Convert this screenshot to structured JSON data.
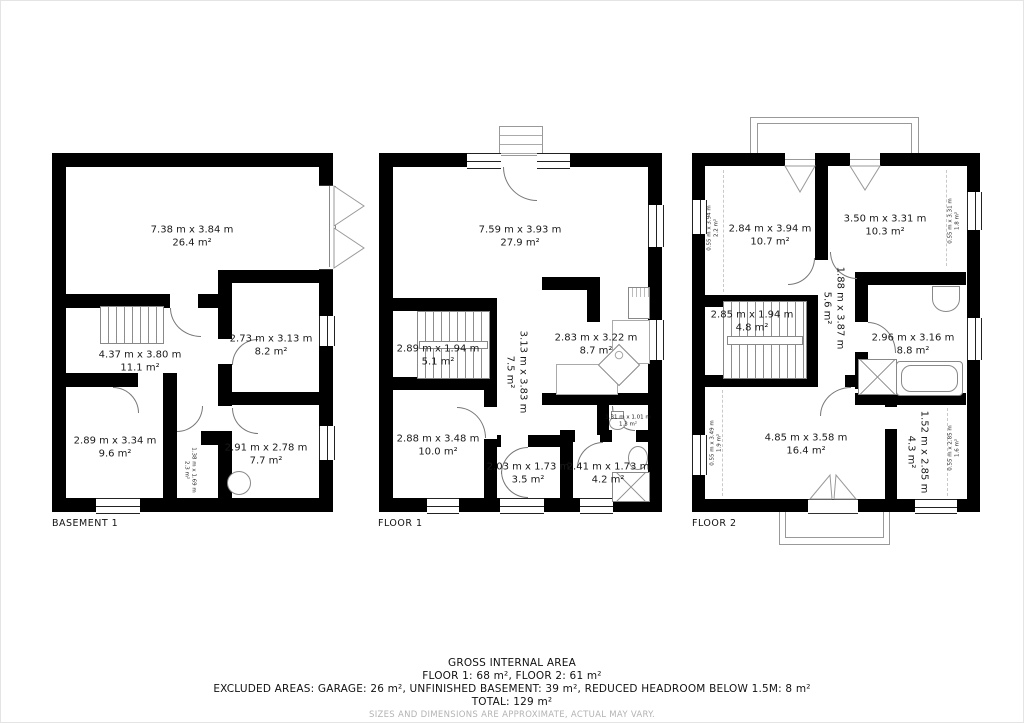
{
  "plans": [
    {
      "label": "BASEMENT 1",
      "rooms": [
        {
          "dims": "7.38 m x 3.84 m",
          "area": "26.4 m²"
        },
        {
          "dims": "4.37 m x 3.80 m",
          "area": "11.1 m²"
        },
        {
          "dims": "2.73 m x 3.13 m",
          "area": "8.2 m²"
        },
        {
          "dims": "2.89 m x 3.34 m",
          "area": "9.6 m²"
        },
        {
          "dims": "1.38 m x 1.69 m",
          "area": "2.3 m²"
        },
        {
          "dims": "2.91 m x 2.78 m",
          "area": "7.7 m²"
        }
      ]
    },
    {
      "label": "FLOOR 1",
      "rooms": [
        {
          "dims": "7.59 m x 3.93 m",
          "area": "27.9 m²"
        },
        {
          "dims": "2.89 m x 1.94 m",
          "area": "5.1 m²"
        },
        {
          "dims": "3.13 m x 3.83 m",
          "area": "7.5 m²"
        },
        {
          "dims": "2.83 m x 3.22 m",
          "area": "8.7 m²"
        },
        {
          "dims": "2.88 m x 3.48 m",
          "area": "10.0 m²"
        },
        {
          "dims": "2.03 m x 1.73 m",
          "area": "3.5 m²"
        },
        {
          "dims": "2.41 m x 1.73 m",
          "area": "4.2 m²"
        },
        {
          "dims": "1.31 m x 1.01 m",
          "area": "1.3 m²"
        }
      ]
    },
    {
      "label": "FLOOR 2",
      "rooms": [
        {
          "dims": "2.84 m x 3.94 m",
          "area": "10.7 m²"
        },
        {
          "dims": "3.50 m x 3.31 m",
          "area": "10.3 m²"
        },
        {
          "dims": "2.85 m x 1.94 m",
          "area": "4.8 m²"
        },
        {
          "dims": "1.88 m x 3.87 m",
          "area": "5.6 m²"
        },
        {
          "dims": "2.96 m x 3.16 m",
          "area": "8.8 m²"
        },
        {
          "dims": "4.85 m x 3.58 m",
          "area": "16.4 m²"
        },
        {
          "dims": "1.52 m x 2.85 m",
          "area": "4.3 m²"
        },
        {
          "dims": "0.55 m x 3.94 m",
          "area": "2.2 m²"
        },
        {
          "dims": "0.55 m x 3.31 m",
          "area": "1.8 m²"
        },
        {
          "dims": "0.55 m x 3.49 m",
          "area": "1.9 m²"
        },
        {
          "dims": "0.55 m x 2.85 m",
          "area": "1.6 m²"
        }
      ]
    }
  ],
  "footer": {
    "title": "GROSS INTERNAL AREA",
    "line1": "FLOOR 1: 68 m², FLOOR 2: 61 m²",
    "line2": "EXCLUDED AREAS: GARAGE: 26 m², UNFINISHED BASEMENT: 39 m², REDUCED HEADROOM BELOW 1.5M: 8 m²",
    "line3": "TOTAL: 129 m²",
    "disclaimer": "SIZES AND DIMENSIONS ARE APPROXIMATE, ACTUAL MAY VARY."
  }
}
